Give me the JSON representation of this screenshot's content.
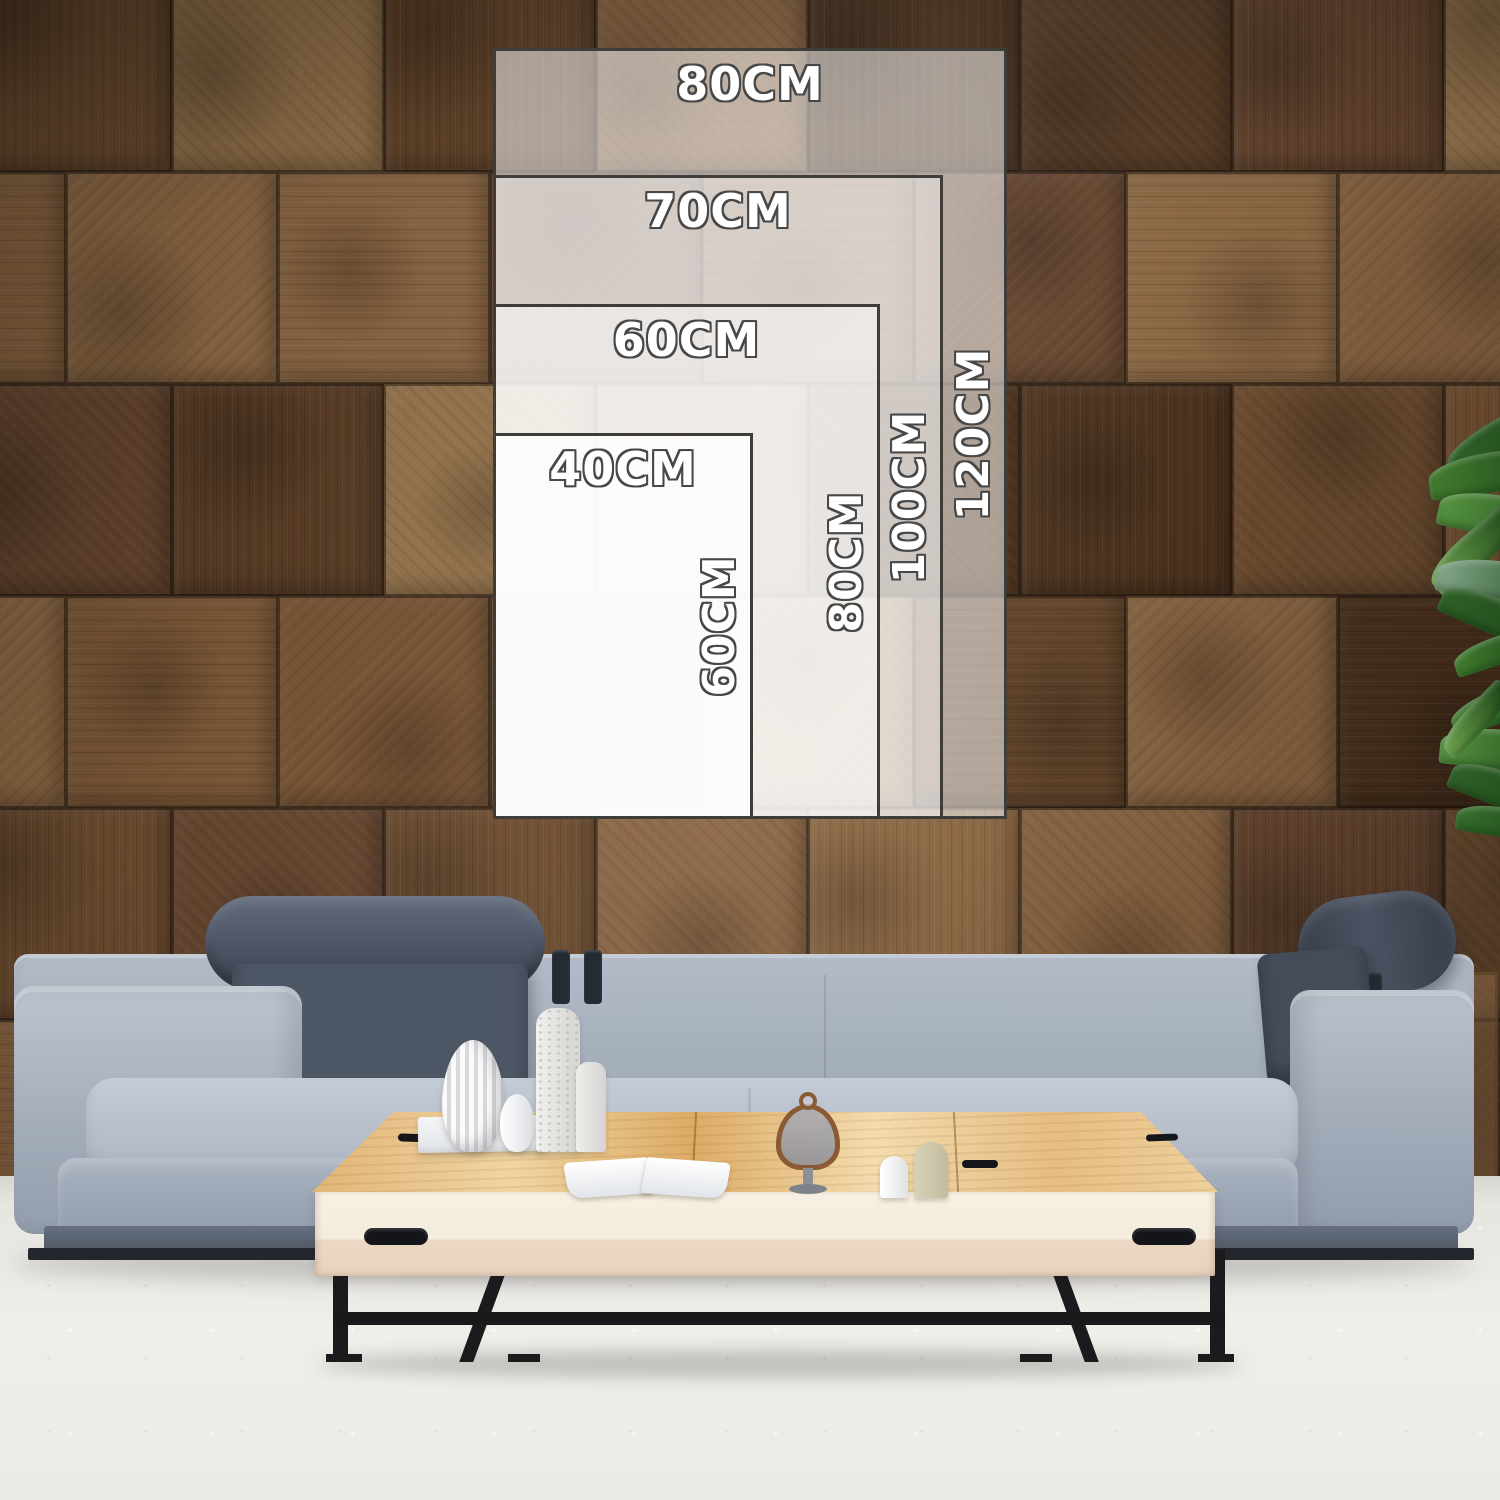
{
  "size_chart": {
    "unit": "CM",
    "overlay_color": "#ffffff",
    "border_color": "#3f3d3a",
    "label_text_color": "#ffffff",
    "label_outline_color": "#474747",
    "sizes": [
      {
        "name": "80x120",
        "width_label": "80CM",
        "height_label": "120CM",
        "box": {
          "left": 493,
          "top": 48,
          "width": 514,
          "height": 771
        }
      },
      {
        "name": "70x100",
        "width_label": "70CM",
        "height_label": "100CM",
        "box": {
          "left": 493,
          "top": 175,
          "width": 450,
          "height": 644
        }
      },
      {
        "name": "60x80",
        "width_label": "60CM",
        "height_label": "80CM",
        "box": {
          "left": 493,
          "top": 304,
          "width": 387,
          "height": 515
        }
      },
      {
        "name": "40x60",
        "width_label": "40CM",
        "height_label": "60CM",
        "box": {
          "left": 493,
          "top": 433,
          "width": 260,
          "height": 386
        }
      }
    ]
  },
  "scene": {
    "colors": {
      "wood_dark": "#54371f",
      "wood_mid": "#6f4e31",
      "wood_light": "#96744c",
      "sofa_fabric": "#a9b2bf",
      "sofa_cushion_dark": "#4a5260",
      "table_wood": "#e5bd83",
      "table_front": "#f3ecdc",
      "floor": "#e9e7e2",
      "plant_green": "#3f7a33",
      "metal_black": "#1c1d1f"
    }
  }
}
